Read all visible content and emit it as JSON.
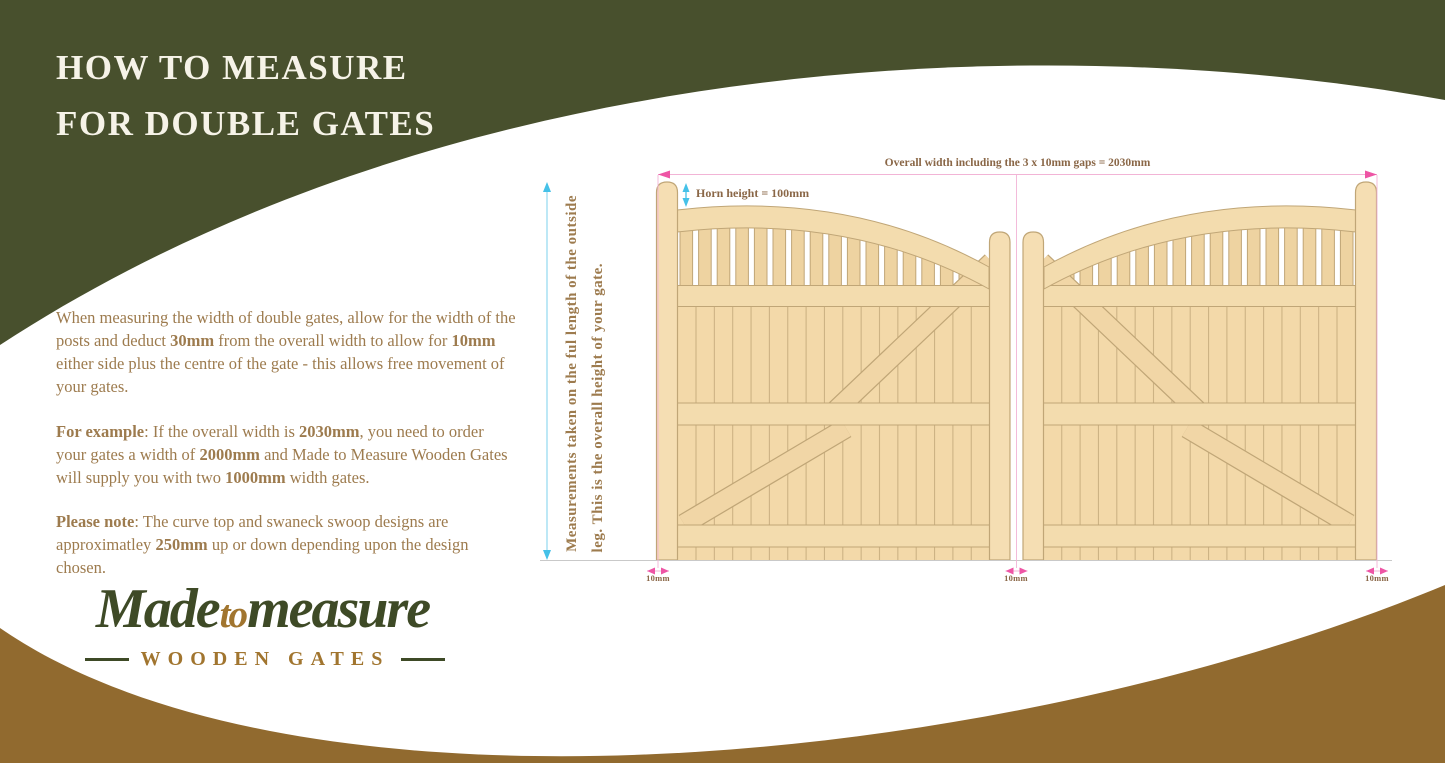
{
  "title": {
    "line1": "HOW TO MEASURE",
    "line2": "FOR DOUBLE GATES"
  },
  "paragraphs": {
    "intro": [
      {
        "t": "When measuring the width of double gates, allow for the width of the posts and deduct "
      },
      {
        "t": "30mm",
        "b": true
      },
      {
        "t": " from the overall width to allow for "
      },
      {
        "t": "10mm",
        "b": true
      },
      {
        "t": " either side plus the centre of the gate - this allows free movement of your gates."
      }
    ],
    "example": [
      {
        "t": "For example",
        "b": true
      },
      {
        "t": ": If the overall width is "
      },
      {
        "t": "2030mm",
        "b": true
      },
      {
        "t": ", you need to order your gates a width of "
      },
      {
        "t": "2000mm",
        "b": true
      },
      {
        "t": " and Made to Measure Wooden Gates will supply you with two "
      },
      {
        "t": "1000mm",
        "b": true
      },
      {
        "t": " width gates."
      }
    ],
    "note": [
      {
        "t": "Please note",
        "b": true
      },
      {
        "t": ": The curve top and swaneck swoop designs are approximatley "
      },
      {
        "t": "250mm",
        "b": true
      },
      {
        "t": " up or down depending upon the design chosen."
      }
    ]
  },
  "diagram": {
    "overall_width_label": "Overall width including the 3 x 10mm gaps = 2030mm",
    "horn_height_label": "Horn height = 100mm",
    "height_note_line1": "Measurements taken on the ful length of the outside",
    "height_note_line2": "leg. This is the overall height of your gate.",
    "gap_labels": [
      "10mm",
      "10mm",
      "10mm"
    ]
  },
  "logo": {
    "made": "Made",
    "to": "to",
    "measure": "measure",
    "tagline": "WOODEN GATES"
  },
  "colors": {
    "green": "#48502d",
    "brown": "#916a2f",
    "title_text": "#f6f3e8",
    "body_text": "#9d7b4e",
    "annotation_text": "#8a6747",
    "logo_green": "#3e4a26",
    "logo_brown": "#a1752f",
    "wood": "#f3d9a9",
    "wood_pale": "#eed3a1",
    "wood_rail": "#f3dcae",
    "wood_stile": "#f5deb3",
    "wood_diag": "#f1d6a6",
    "wood_outline": "#c0a677",
    "wood_joint": "#cdb384",
    "pink": "#ee55a5",
    "pink_light": "#f2b4d6",
    "cyan": "#45c1e8",
    "cyan_light": "#9adcf2",
    "baseline": "#c9c9c9"
  }
}
